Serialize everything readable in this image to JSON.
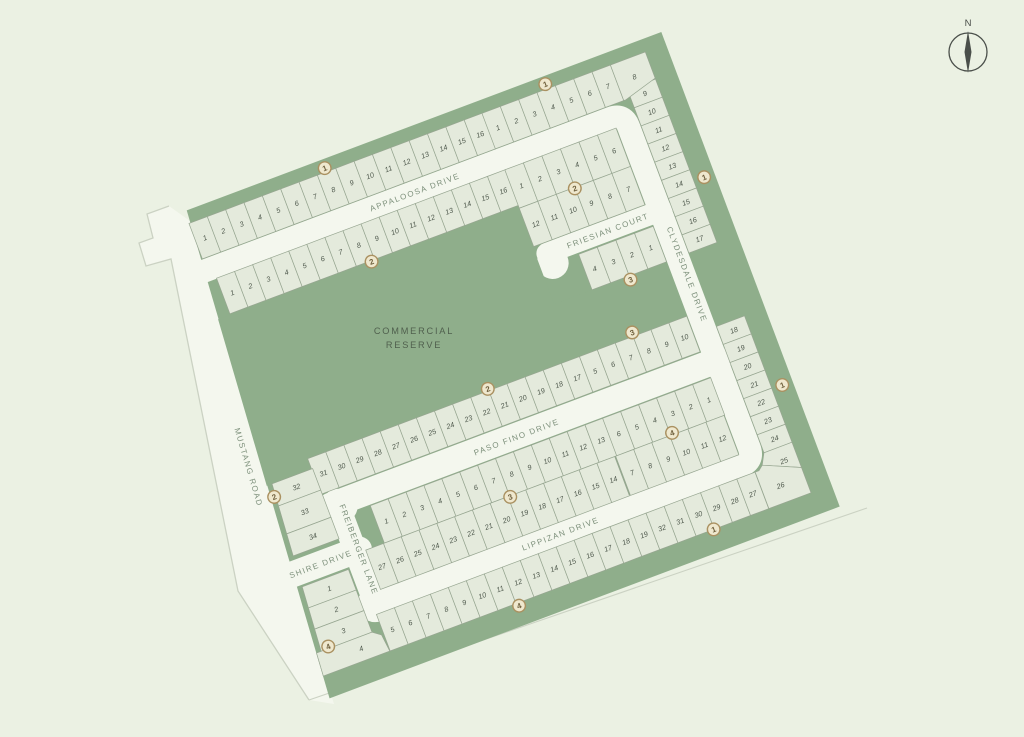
{
  "map": {
    "title": "subdivision-plat-map",
    "north_label": "N",
    "reserve_label": [
      "COMMERCIAL",
      "RESERVE"
    ],
    "streets": {
      "appaloosa": "APPALOOSA DRIVE",
      "friesian": "FRIESIAN COURT",
      "clydesdale": "CLYDESDALE DRIVE",
      "paso_fino": "PASO FINO DRIVE",
      "lippizan": "LIPPIZAN DRIVE",
      "mustang": "MUSTANG ROAD",
      "shire": "SHIRE DRIVE",
      "freiberger": "FREIBERGER LANE"
    },
    "lot_rows": {
      "row_a_west": [
        "1",
        "2",
        "3",
        "4",
        "5",
        "6",
        "7",
        "8",
        "9",
        "10",
        "11",
        "12",
        "13",
        "14",
        "15",
        "16"
      ],
      "row_a_corner": [
        "1",
        "2",
        "3",
        "4",
        "5",
        "6",
        "7",
        "8"
      ],
      "clydesdale_upper": [
        "9",
        "10",
        "11",
        "12",
        "13",
        "14",
        "15",
        "16",
        "17"
      ],
      "row_b": [
        "1",
        "2",
        "3",
        "4",
        "5",
        "6",
        "7",
        "8",
        "9",
        "10",
        "11",
        "12",
        "13",
        "14",
        "15",
        "16"
      ],
      "friesian_north": [
        "1",
        "2",
        "3",
        "4",
        "5",
        "6"
      ],
      "friesian_south": [
        "12",
        "11",
        "10",
        "9",
        "8",
        "7"
      ],
      "court_south": [
        "4",
        "3",
        "2",
        "1"
      ],
      "paso_north_west": [
        "31",
        "30",
        "29",
        "28",
        "27",
        "26",
        "25",
        "24",
        "23",
        "22",
        "21",
        "20",
        "19",
        "18",
        "17"
      ],
      "paso_north_east": [
        "5",
        "6",
        "7",
        "8",
        "9",
        "10"
      ],
      "middle_nw": [
        "1",
        "2",
        "3",
        "4",
        "5",
        "6",
        "7",
        "8",
        "9",
        "10",
        "11",
        "12",
        "13"
      ],
      "middle_sw": [
        "27",
        "26",
        "25",
        "24",
        "23",
        "22",
        "21",
        "20",
        "19",
        "18",
        "17",
        "16",
        "15",
        "14"
      ],
      "middle_ne": [
        "6",
        "5",
        "4",
        "3",
        "2",
        "1"
      ],
      "middle_se": [
        "7",
        "8",
        "9",
        "10",
        "11",
        "12"
      ],
      "clydesdale_lower": [
        "18",
        "19",
        "20",
        "21",
        "22",
        "23",
        "24"
      ],
      "corner_se": [
        "25",
        "26"
      ],
      "lippizan_stage4": [
        "5",
        "6",
        "7",
        "8",
        "9",
        "10",
        "11",
        "12",
        "13",
        "14",
        "15",
        "16",
        "17",
        "18",
        "19"
      ],
      "lippizan_stage1": [
        "32",
        "31",
        "30",
        "29",
        "28",
        "27"
      ],
      "mustang_lots": [
        "32",
        "33",
        "34"
      ],
      "shire_stack": [
        "1",
        "2",
        "3",
        "4"
      ]
    },
    "stage_markers": [
      {
        "stage": "1"
      },
      {
        "stage": "1"
      },
      {
        "stage": "1"
      },
      {
        "stage": "1"
      },
      {
        "stage": "1"
      },
      {
        "stage": "2"
      },
      {
        "stage": "2"
      },
      {
        "stage": "2"
      },
      {
        "stage": "2"
      },
      {
        "stage": "3"
      },
      {
        "stage": "3"
      },
      {
        "stage": "3"
      },
      {
        "stage": "4"
      },
      {
        "stage": "4"
      },
      {
        "stage": "4"
      }
    ],
    "colors": {
      "background": "#EBF1E3",
      "greenbelt": "#8FAE8B",
      "road": "#F4F7EE",
      "lot_fill": "#E4EADC",
      "lot_stroke": "#97A691",
      "lot_number": "#4E584C",
      "street_label": "#7D907B",
      "reserve_label": "#50604E",
      "marker_fill": "#EFE8CE",
      "marker_stroke": "#AA9161",
      "marker_text": "#6E5F3C",
      "boundary_line": "#CBD2C3",
      "north_arrow": "#4A4F4A"
    }
  }
}
